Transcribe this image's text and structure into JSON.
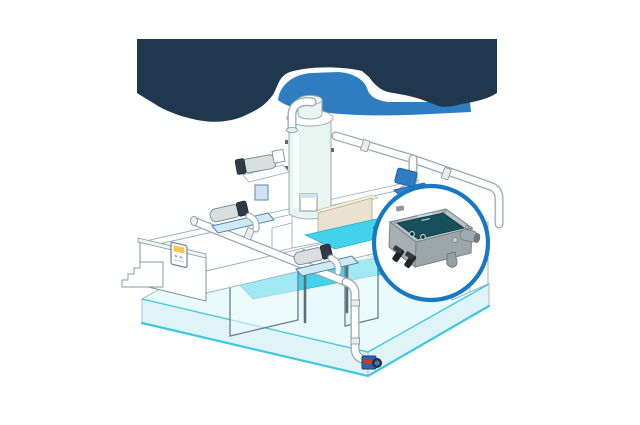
{
  "image": {
    "width": 640,
    "height": 425,
    "background": "#FFFFFF"
  },
  "colors": {
    "navy": "#20384E",
    "blob-blue": "#2E7DC0",
    "callout-border": "#1779C6",
    "pool-pale": "#E8FAFC",
    "pool-wall": "#D7F1F6",
    "aqua-edge": "#3EC8E0",
    "cyan-bright": "#42D2EA",
    "cyan-deep": "#29ACC8",
    "panel-teal": "#17505C",
    "device-lid": "#B9C3C6",
    "device-side": "#9AA6AA",
    "base-blue": "#3F7FD0",
    "marker-blue": "#2E7CC2",
    "pump-blue": "#2F63AE",
    "pump-red": "#C23B2E",
    "label-yellow": "#F5C84C",
    "tower-fill": "#E9F5F0",
    "pipe-fill": "#FDFFFF"
  },
  "components": [
    "splash-navy-shape",
    "splash-blue-shape",
    "pool-basin",
    "water-channels",
    "glass-partitions",
    "plant-room-platform",
    "filter-tower",
    "back-pump",
    "circulation-pump-1",
    "circulation-pump-2",
    "front-pipe-run",
    "overhead-pipe-run",
    "down-pipe",
    "outlet-pump",
    "wall-control-box",
    "stairs",
    "right-cabinets",
    "sensor-location-marker",
    "callout-circle",
    "controller-device"
  ]
}
